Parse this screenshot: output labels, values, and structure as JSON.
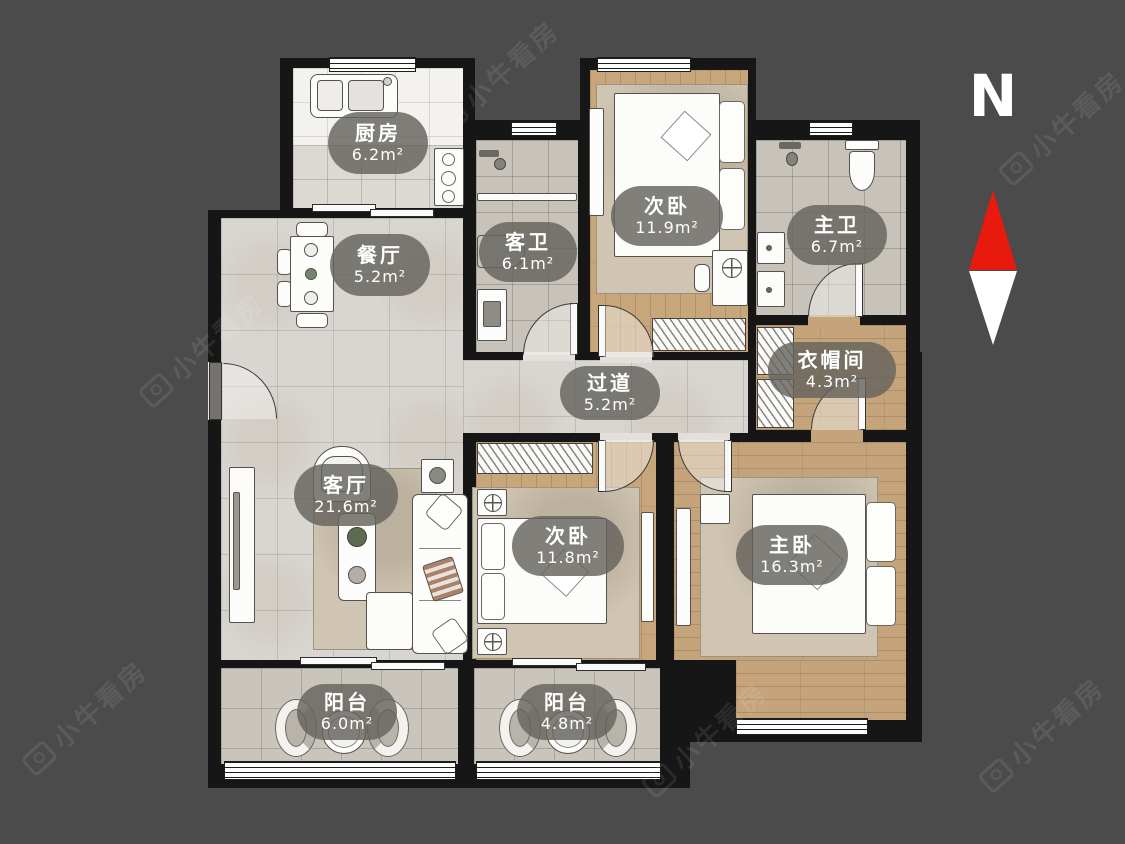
{
  "watermark": {
    "brand": "小牛看房"
  },
  "compass": {
    "label": "N",
    "arrow_up_color": "#e8190d",
    "arrow_down_color": "#ffffff"
  },
  "colors": {
    "background": "#4b4b4b",
    "wall": "#161616",
    "marble_floor": "#d9d6d1",
    "wood_floor": "#c7a67c",
    "tile_floor": "#c7c3bb",
    "label_bg": "rgba(101,99,93,0.82)",
    "label_text": "#ffffff"
  },
  "rooms": [
    {
      "id": "kitchen",
      "name": "厨房",
      "area": "6.2m²"
    },
    {
      "id": "dining",
      "name": "餐厅",
      "area": "5.2m²"
    },
    {
      "id": "guest-bath",
      "name": "客卫",
      "area": "6.1m²"
    },
    {
      "id": "bedroom-north",
      "name": "次卧",
      "area": "11.9m²"
    },
    {
      "id": "master-bath",
      "name": "主卫",
      "area": "6.7m²"
    },
    {
      "id": "closet",
      "name": "衣帽间",
      "area": "4.3m²"
    },
    {
      "id": "hallway",
      "name": "过道",
      "area": "5.2m²"
    },
    {
      "id": "living",
      "name": "客厅",
      "area": "21.6m²"
    },
    {
      "id": "bedroom-south",
      "name": "次卧",
      "area": "11.8m²"
    },
    {
      "id": "master-bedroom",
      "name": "主卧",
      "area": "16.3m²"
    },
    {
      "id": "balcony-west",
      "name": "阳台",
      "area": "6.0m²"
    },
    {
      "id": "balcony-east",
      "name": "阳台",
      "area": "4.8m²"
    }
  ]
}
